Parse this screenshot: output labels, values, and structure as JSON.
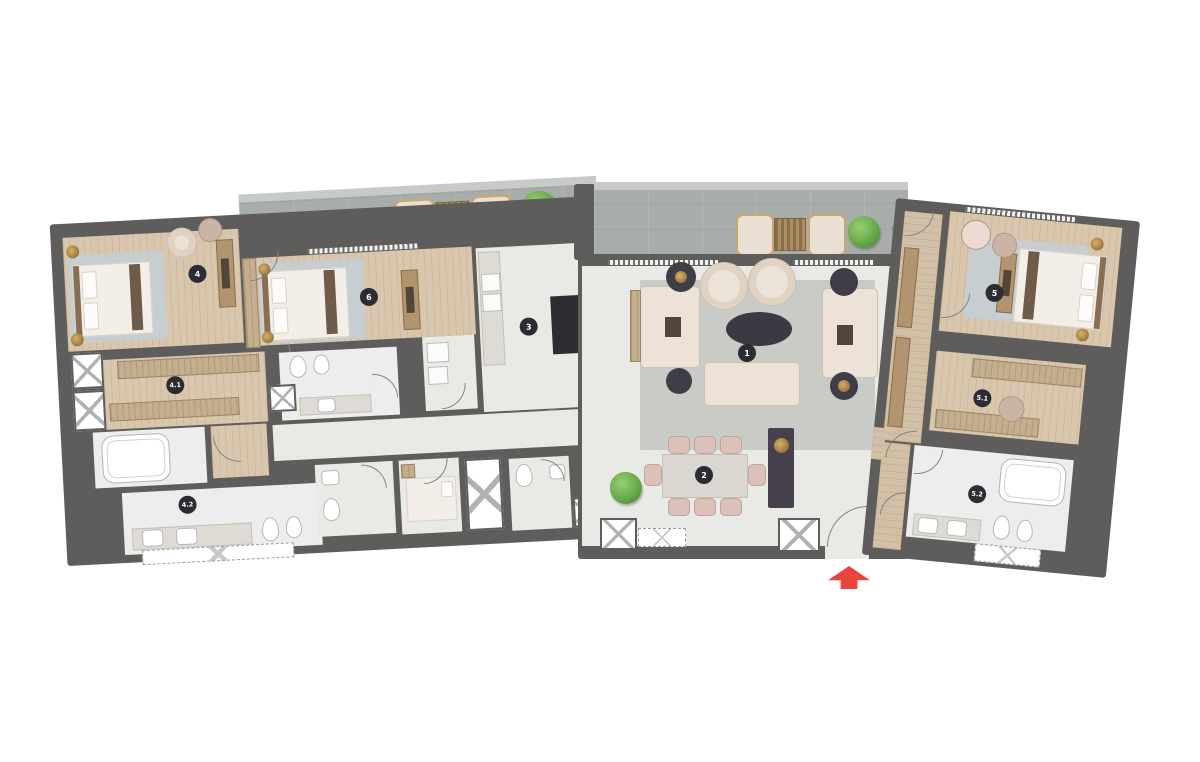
{
  "floor_plan": {
    "kind": "apartment-floor-plan",
    "rooms": [
      {
        "label": "1",
        "name": "living-room"
      },
      {
        "label": "2",
        "name": "dining-area"
      },
      {
        "label": "3",
        "name": "kitchen"
      },
      {
        "label": "4",
        "name": "bedroom-4"
      },
      {
        "label": "4.1",
        "name": "dressing-room-4-1"
      },
      {
        "label": "4.2",
        "name": "bathroom-4-2"
      },
      {
        "label": "5",
        "name": "bedroom-5"
      },
      {
        "label": "5.1",
        "name": "dressing-room-5-1"
      },
      {
        "label": "5.2",
        "name": "bathroom-5-2"
      },
      {
        "label": "6",
        "name": "bedroom-6"
      }
    ],
    "entrance": {
      "marker": "red-arrow",
      "direction": "up"
    },
    "colors": {
      "wall": "#5e5d5b",
      "balcony": "#a9adaa",
      "wood_floor": "#d9c7ad",
      "tile_floor": "#e9e9e6",
      "rug_blue": "#c7ced2",
      "rug_gray": "#c9cbc7",
      "furniture_cream": "#ece2d7",
      "accent_gold": "#b68f4e",
      "accent_dark": "#3b3943",
      "plant_green": "#68a94a",
      "entrance_arrow": "#e8433c",
      "badge": "#2d2c34"
    }
  }
}
